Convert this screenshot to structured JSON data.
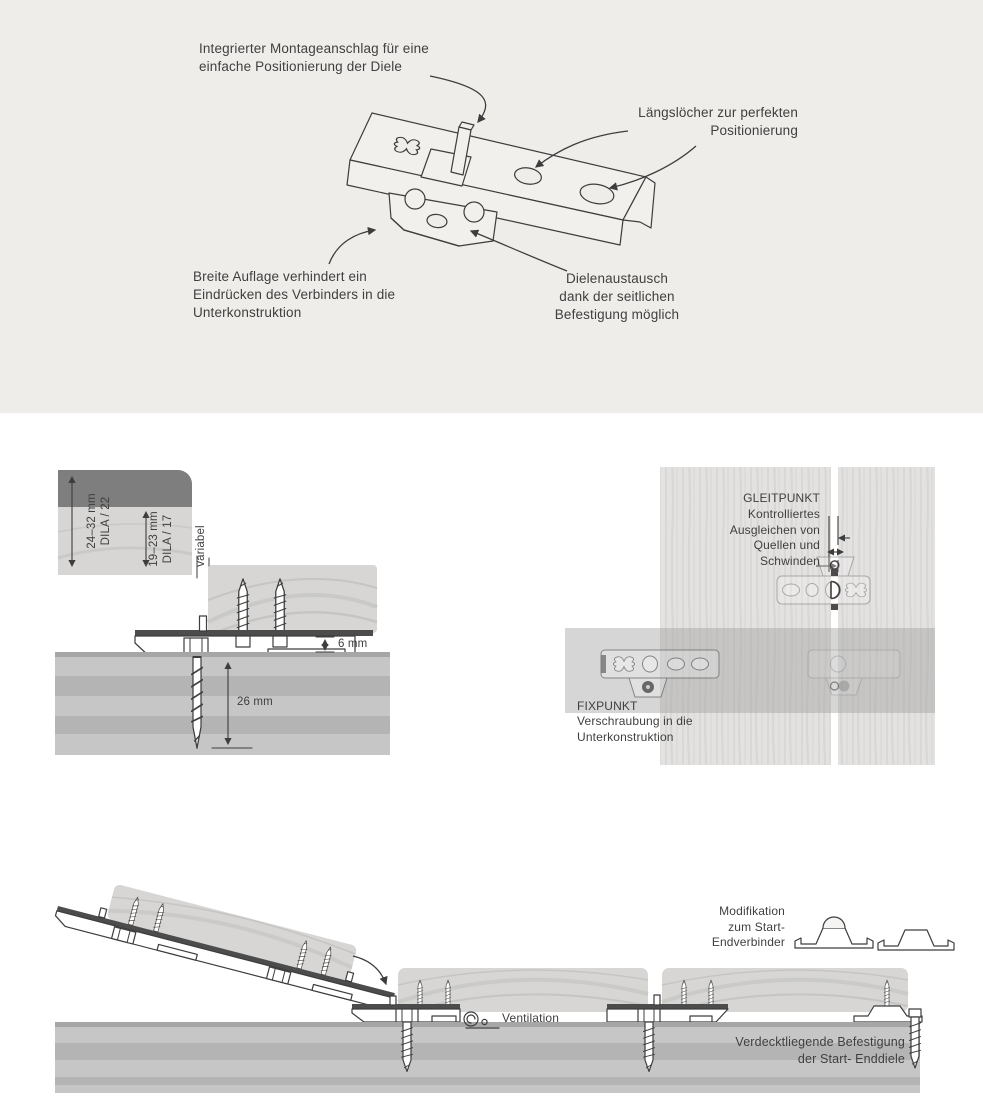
{
  "colors": {
    "panel_bg": "#efedea",
    "line": "#3d3d3d",
    "text": "#3f3f3f",
    "wood": "#d7d6d4",
    "wood_grain": "#c6c5c3",
    "wood_dark": "#7e7e7e",
    "plank": "#e3e2e0",
    "substructure": "#c6c6c6",
    "substructure_stripe": "#b4b4b4",
    "substructure_edge": "#a6a6a6",
    "metal_dark": "#4c4c4c"
  },
  "icons": {
    "ventilation_icon": "spiral-vent-symbol"
  },
  "top_panel": {
    "labels": {
      "montageanschlag": "Integrierter Montageanschlag für eine\neinfache Positionierung der Diele",
      "langsloecher": "Längslöcher zur perfekten\nPositionierung",
      "auflage": "Breite Auflage verhindert ein\nEindrücken des Verbinders in die\nUnterkonstruktion",
      "austausch": "Dielenaustausch\ndank der seitlichen\nBefestigung möglich"
    }
  },
  "cross_section": {
    "dim_board_thick_1": "24–32 mm\nDILA / 22",
    "dim_board_thick_2": "19–23 mm\nDILA / 17",
    "variabel": "variabel",
    "gap_height": "6 mm",
    "screw_depth": "26 mm"
  },
  "top_view": {
    "gleitpunkt_title": "GLEITPUNKT",
    "gleitpunkt_text": "Kontrolliertes\nAusgleichen von\nQuellen und\nSchwinden",
    "fixpunkt_title": "FIXPUNKT",
    "fixpunkt_text": "Verschraubung in die\nUnterkonstruktion"
  },
  "installation": {
    "modifikation": "Modifikation\nzum Start-\nEndverbinder",
    "ventilation": "Ventilation",
    "verdeckt": "Verdecktliegende Befestigung\nder Start- Enddiele"
  }
}
